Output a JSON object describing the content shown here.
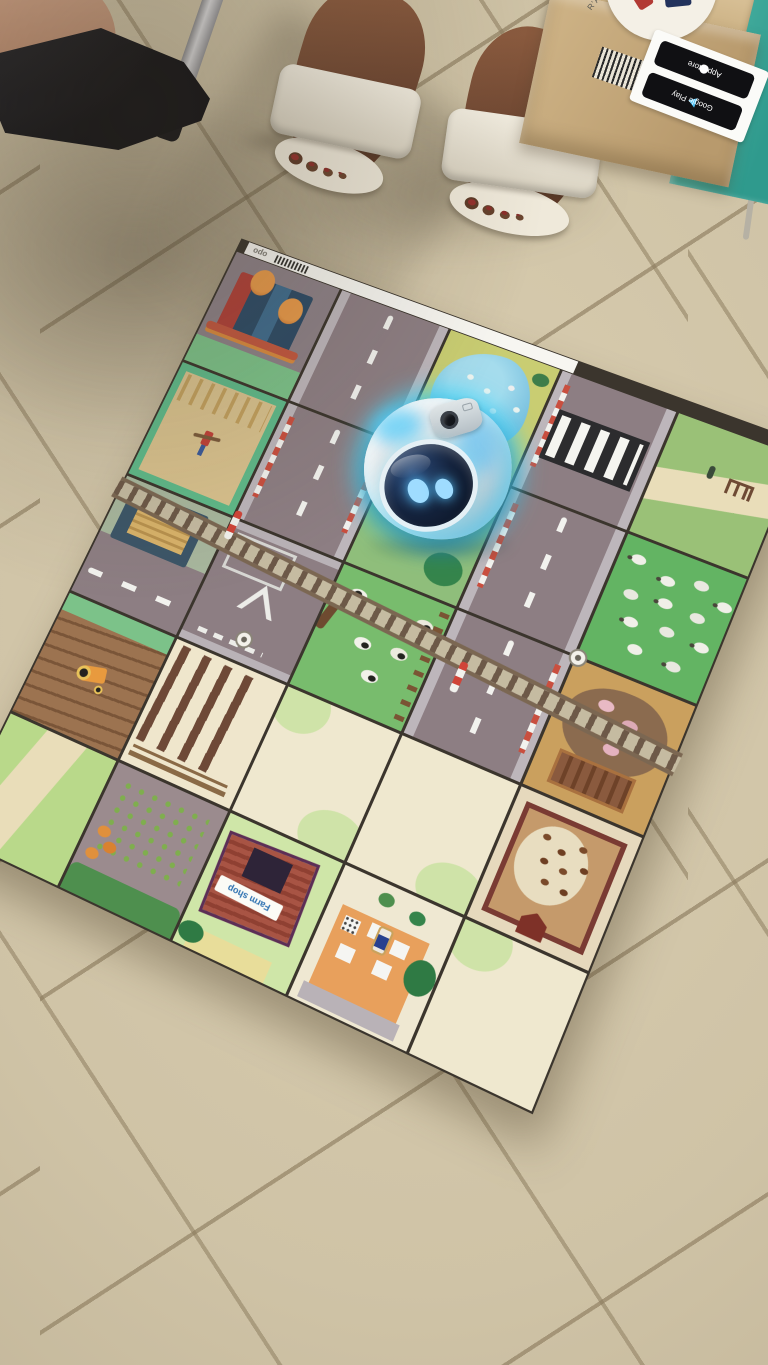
{
  "scene": {
    "description": "Photograph: a white educational floor robot with a glowing cyan LED ring and blue eye display sits on a farm-and-town coding activity mat laid over a beige tiled floor; two people's feet (black pointed shoe, white heeled sandals), a metal chair leg and a cardboard product box surround the mat",
    "floor_color": "#cfc3a6",
    "grout_color": "#8d7d5f"
  },
  "mat": {
    "logo_text": "opo",
    "farm_shop_sign": "Farm shop",
    "grid": "5x5 tiles",
    "border_color": "#3b352d",
    "tiles": [
      [
        "market stalls with orange trees",
        "road",
        "duck pond",
        "zebra crossing",
        "path with gate"
      ],
      [
        "hay field with scarecrow",
        "road with level crossing",
        "grass with trees (robot here)",
        "road",
        "sheep field"
      ],
      [
        "timber yard and road",
        "road junction with give-way triangle",
        "cow pasture",
        "road",
        "pig pen"
      ],
      [
        "plowed field with tractor",
        "furrow rows",
        "open field",
        "open field",
        "chicken coop"
      ],
      [
        "grass corner path",
        "vegetable garden",
        "farm shop",
        "farmhouse with car",
        "open field"
      ]
    ],
    "railway": "track strip crossing the mat with red-white crossing barriers",
    "marker_badges": 2
  },
  "robot": {
    "kind": "educational floor robot",
    "body_color": "#e8eef1",
    "led_ring_color": "#4fd9ff",
    "face_screen_color": "#15243f",
    "eye_color": "#9fdcff",
    "features": [
      "camera lens on top",
      "glowing LED ring",
      "dark face display with two blue eyes"
    ]
  },
  "box": {
    "badge_labels": [
      "App Store",
      "Google Play"
    ],
    "brand_text": "R'AÑE",
    "panel_color": "#3fae9f",
    "kraft_color": "#c8ab7e",
    "has_barcode": true,
    "orientation": "badges and label appear upside down"
  }
}
